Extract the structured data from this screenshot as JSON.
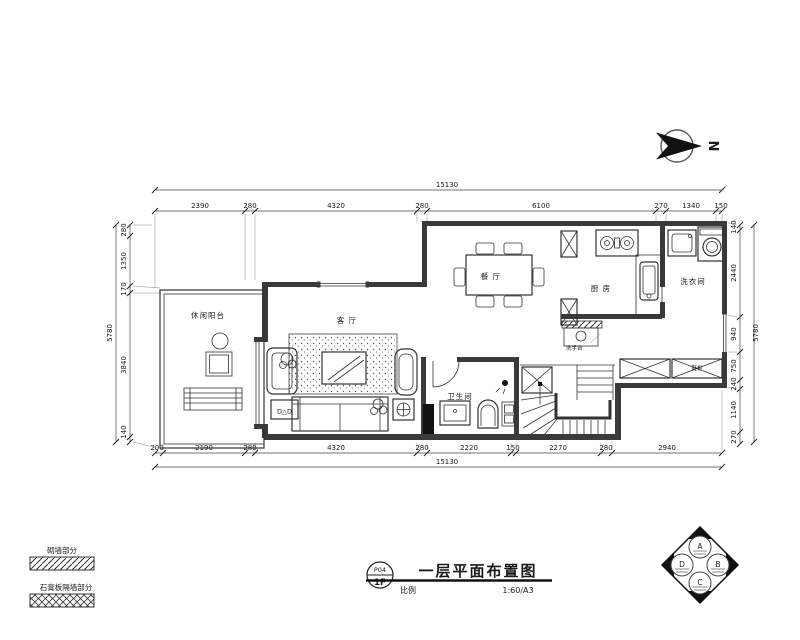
{
  "sheet": {
    "title": "一层平面布置图",
    "tag_top": "P04",
    "tag_bottom": "1F",
    "scale_label": "比例",
    "scale_value": "1:60/A3",
    "north_letter": "N"
  },
  "rooms": {
    "balcony": "休闲阳台",
    "living": "客 厅",
    "dining": "餐 厅",
    "kitchen": "厨 房",
    "laundry": "洗衣间",
    "bath": "卫生间",
    "cabinet": "鞋柜",
    "basin_note": "洗手台",
    "dvd": "D△D"
  },
  "dims": {
    "overall_width": "15130",
    "overall_height": "5780",
    "top": [
      "2390",
      "280",
      "4320",
      "280",
      "6100",
      "270",
      "1340",
      "150"
    ],
    "bottom": [
      "200",
      "2190",
      "280",
      "4320",
      "280",
      "2220",
      "150",
      "2270",
      "280",
      "2940"
    ],
    "left": [
      "280",
      "1350",
      "170",
      "3840",
      "140"
    ],
    "right": [
      "140",
      "2440",
      "940",
      "750",
      "240",
      "1140",
      "270"
    ]
  },
  "legend": {
    "wall_label": "砌墙部分",
    "partition_label": "石膏板隔墙部分"
  },
  "logo": {
    "top": "A",
    "right": "B",
    "bottom": "C",
    "left": "D"
  }
}
